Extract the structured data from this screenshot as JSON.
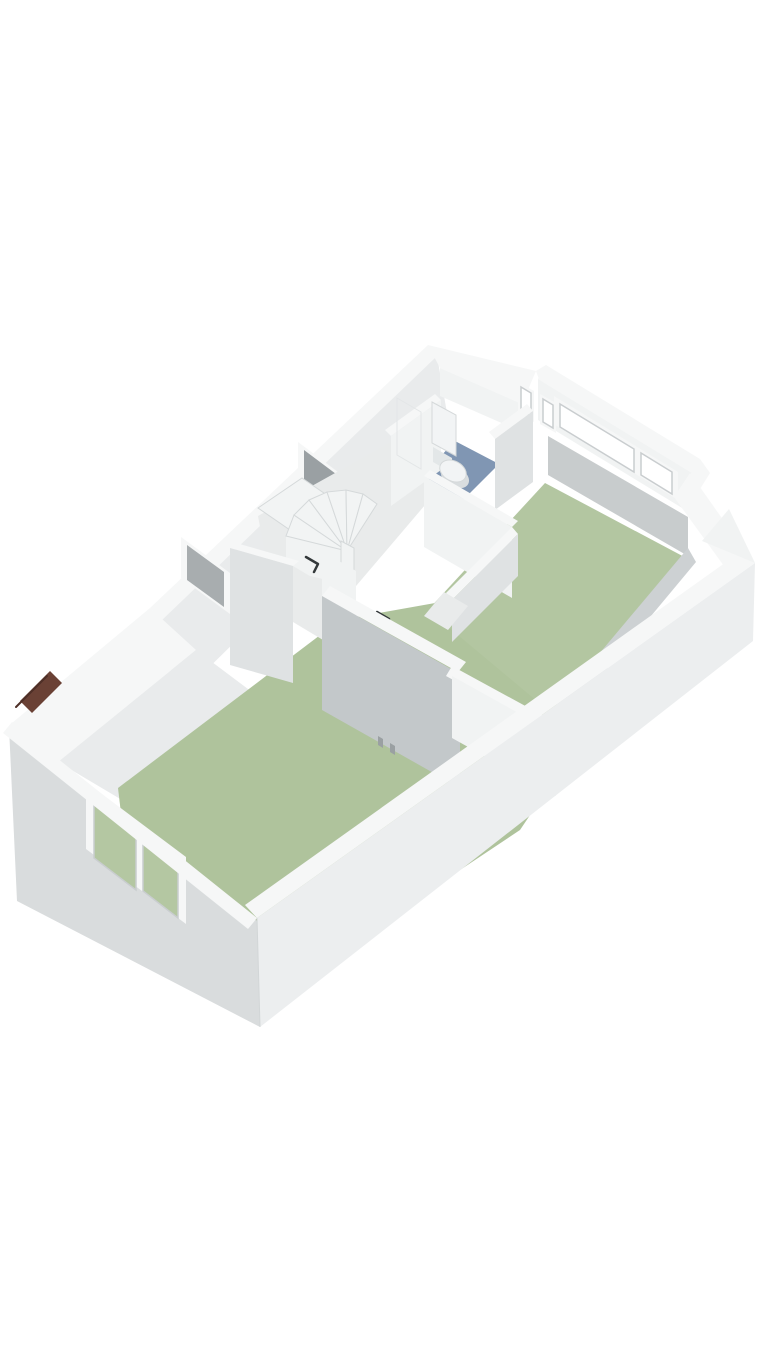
{
  "scene": {
    "type": "axonometric-3d-floorplan",
    "description": "3D rendered floor plan of an upper storey, viewed from above at an angle",
    "background": "#ffffff"
  },
  "colors": {
    "capWhite": "#f6f7f7",
    "faceBright": "#f1f3f3",
    "faceLight": "#e9ebec",
    "faceMid": "#dfe2e3",
    "faceGray": "#c8cccd",
    "faceDark": "#c3c8ca",
    "innerShade": "#cdd1d3",
    "extLeft": "#d9dcdd",
    "extRight": "#eceeef",
    "floorHall": "#e9ebeb",
    "glassDark": "#9aa0a3",
    "glassGray": "#a8adaf",
    "glassGreen": "#b4c7a2",
    "paneWhite": "#ffffff",
    "roofBrown": "#6a4135",
    "roofBrownDark": "#4e2f27",
    "mirror": "#ccd6dc",
    "stairTread": "#f2f4f4",
    "toiletWhite": "#f2f4f5",
    "toiletShade": "#e3e7e8",
    "shadow": "#d9dddf",
    "handle": "#9aa0a2"
  },
  "rooms": [
    {
      "id": "bedroom-left",
      "floor_color": "#afc39c"
    },
    {
      "id": "bedroom-right",
      "floor_color": "#b3c6a1"
    },
    {
      "id": "bathroom",
      "floor_color": "#8096b3"
    },
    {
      "id": "landing",
      "floor_color": "#e9ebeb"
    }
  ],
  "fixtures": [
    "winder-staircase",
    "wall-hung-toilet",
    "mirror-panel",
    "bathroom-cabinet",
    "closet-wall-with-two-handles"
  ],
  "windows": [
    "stair-window",
    "small-side-window",
    "dormer-window-band",
    "slit-window-1",
    "slit-window-2",
    "front-double-window"
  ],
  "markers": {
    "door_swing_count": 2
  }
}
